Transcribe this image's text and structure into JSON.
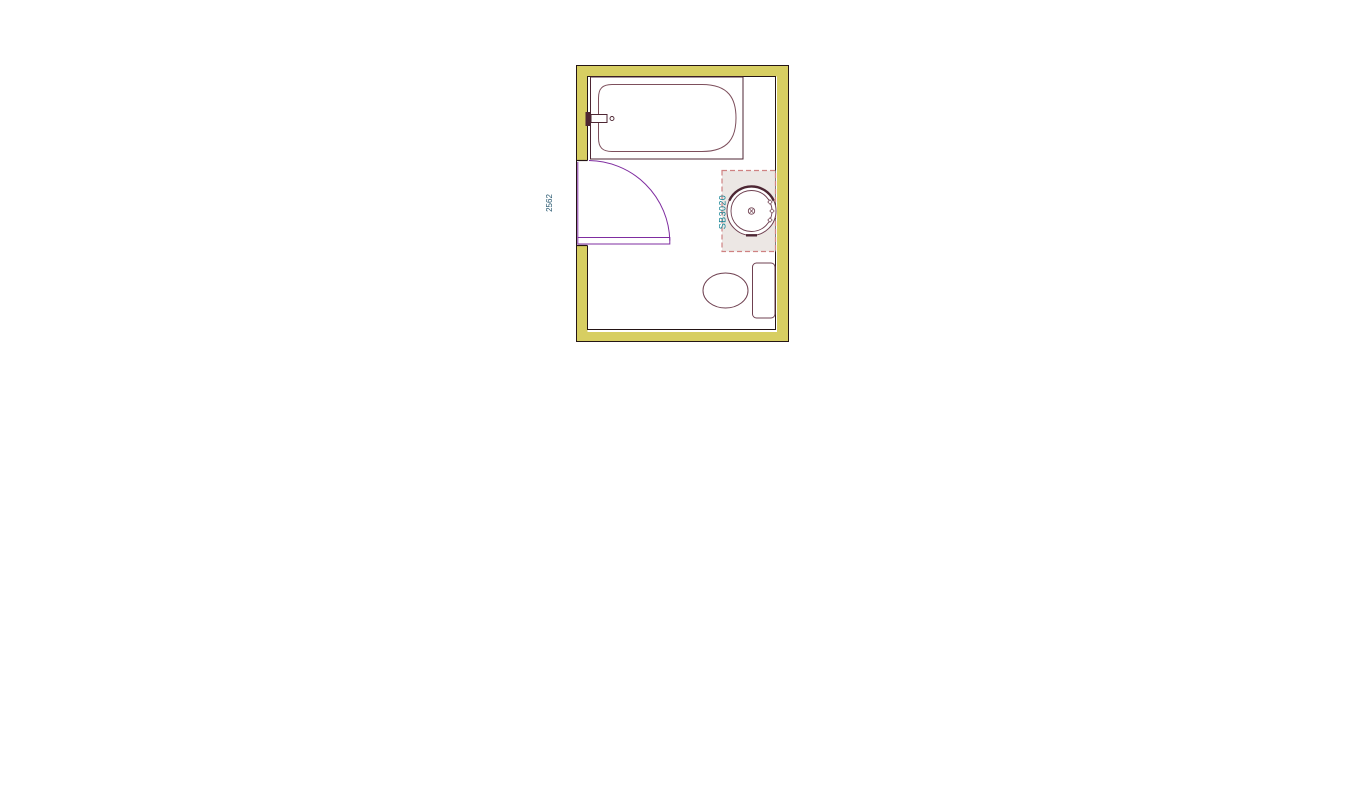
{
  "page": {
    "background_color": "#ffffff",
    "content": "bathroom-floor-plan"
  },
  "floorplan": {
    "dimension_label": "2562",
    "washbasin_label": "SB3020",
    "fixtures": {
      "bathtub": "bathtub with wall faucet",
      "door": "left-hinged door with quarter-circle swing",
      "washbasin": "round countertop basin on dashed service area",
      "toilet": "toilet bowl with cistern"
    },
    "colors": {
      "wall_fill": "#d7ce62",
      "wall_outline": "#241515",
      "enclosure_outline": "#4d2633",
      "tub_outline": "#7d4f5c",
      "fixture_outline": "#6f4050",
      "door_purple": "#7f2da0",
      "basin_area_fill": "#ece7e4",
      "basin_area_dash": "#cf8282",
      "washbasin_label_color": "#0e8092",
      "dimension_label_color": "#27576f"
    }
  }
}
